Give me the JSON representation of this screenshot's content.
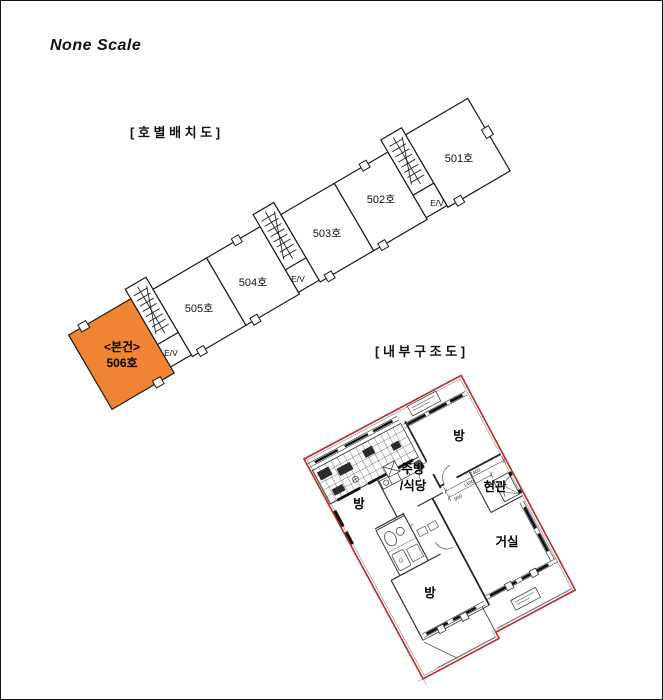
{
  "page": {
    "scale_note": "None Scale"
  },
  "unit_layout": {
    "title": "[ 호 별 배 치 도 ]",
    "elevator_label": "E/V",
    "highlight_color": "#ef8432",
    "units": [
      {
        "label": "501호",
        "highlighted": false
      },
      {
        "label": "502호",
        "highlighted": false
      },
      {
        "label": "503호",
        "highlighted": false
      },
      {
        "label": "504호",
        "highlighted": false
      },
      {
        "label": "505호",
        "highlighted": false
      },
      {
        "label": "506호",
        "marker": "<본건>",
        "highlighted": true
      }
    ]
  },
  "floor_plan": {
    "title": "[ 내 부 구 조 도 ]",
    "boundary_color": "#c22525",
    "rooms": [
      {
        "label": "방",
        "position": "top"
      },
      {
        "label": "주방",
        "label_line2": "/식당",
        "position": "center"
      },
      {
        "label": "현관",
        "position": "right"
      },
      {
        "label": "방",
        "position": "left"
      },
      {
        "label": "거실",
        "position": "bottom-right"
      },
      {
        "label": "방",
        "position": "bottom"
      }
    ],
    "dimensions": [
      "2400",
      "1400",
      "900"
    ]
  }
}
